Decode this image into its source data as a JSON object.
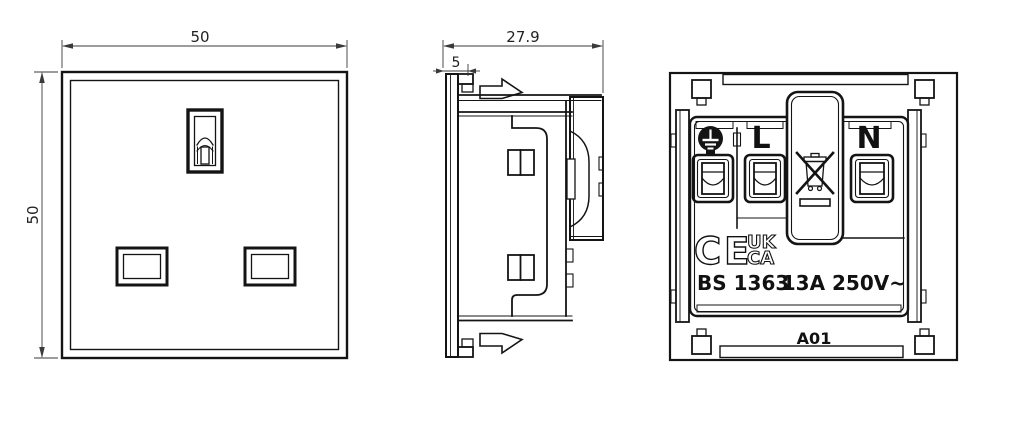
{
  "window": {
    "background": "#ffffff",
    "line_color": "#141414",
    "dimension_color": "#3a3a3a"
  },
  "views": {
    "front": {
      "dimensions": {
        "width": "50",
        "height": "50"
      }
    },
    "side": {
      "dimensions": {
        "depth": "27.9",
        "flange": "5"
      }
    },
    "rear": {
      "labels": {
        "live": "L",
        "neutral": "N"
      },
      "markings": {
        "standard": "BS 1363",
        "rating": "13A 250V~",
        "model": "A01",
        "ce_mark": "CE",
        "ukca_mark_line1": "UK",
        "ukca_mark_line2": "CA"
      },
      "icons": [
        "earth-ground-icon",
        "weee-crossed-bin-icon"
      ]
    }
  }
}
